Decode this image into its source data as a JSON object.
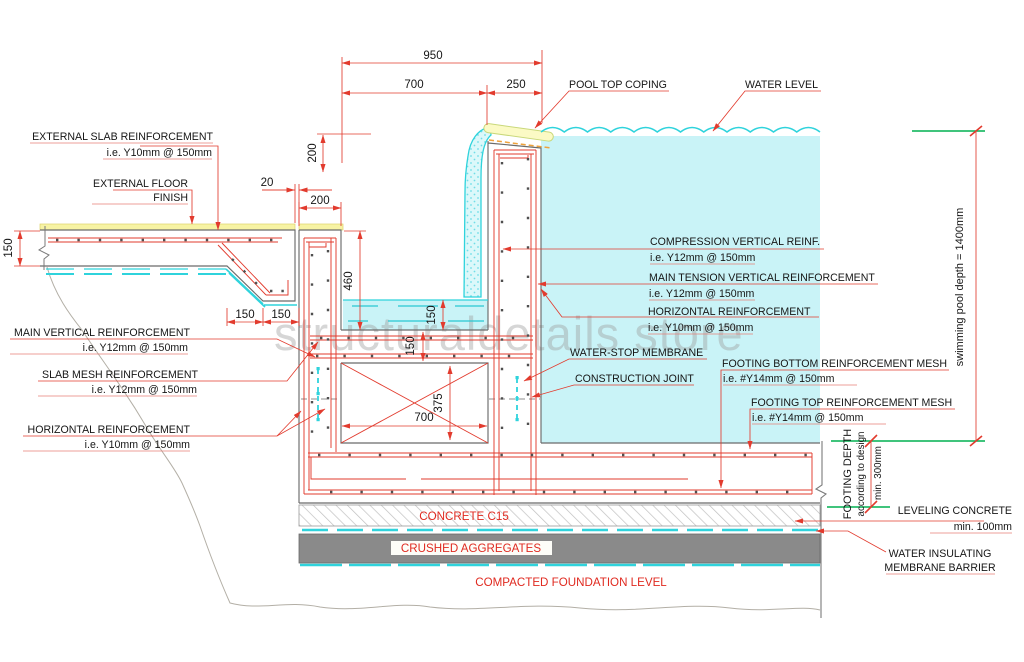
{
  "watermark": "structuraldetails store",
  "dims": {
    "total_width": "950",
    "channel_width": "700",
    "wall_top_width": "250",
    "coping_height": "200",
    "gutter_wall_width": "200",
    "expansion_joint": "20",
    "slab_thickness": "150",
    "slab_edge_seg1": "150",
    "slab_edge_seg2": "150",
    "gutter_depth": "460",
    "gutter_water_depth": "150",
    "gutter_slab_thickness": "150",
    "footing_key_width": "700",
    "footing_key_height": "375"
  },
  "annotations": {
    "external_slab_reinforcement": "EXTERNAL SLAB REINFORCEMENT",
    "external_slab_reinforcement_spec": "i.e. Y10mm @ 150mm",
    "external_floor_finish_1": "EXTERNAL FLOOR",
    "external_floor_finish_2": "FINISH",
    "main_vertical_reinforcement": "MAIN VERTICAL REINFORCEMENT",
    "main_vertical_reinforcement_spec": "i.e. Y12mm @ 150mm",
    "slab_mesh_reinforcement": "SLAB MESH REINFORCEMENT",
    "slab_mesh_reinforcement_spec": "i.e. Y12mm @ 150mm",
    "horizontal_reinforcement_left": "HORIZONTAL REINFORCEMENT",
    "horizontal_reinforcement_left_spec": "i.e. Y10mm @ 150mm",
    "pool_top_coping": "POOL TOP COPING",
    "water_level": "WATER LEVEL",
    "compression_vertical_reinf": "COMPRESSION VERTICAL REINF.",
    "compression_vertical_reinf_spec": "i.e. Y12mm @ 150mm",
    "main_tension_vertical_reinforcement": "MAIN TENSION VERTICAL REINFORCEMENT",
    "main_tension_spec": "i.e. Y12mm @ 150mm",
    "horizontal_reinforcement_right": "HORIZONTAL REINFORCEMENT",
    "horizontal_reinforcement_right_spec": "i.e. Y10mm @ 150mm",
    "water_stop_membrane": "WATER-STOP MEMBRANE",
    "construction_joint": "CONSTRUCTION JOINT",
    "footing_bottom_mesh": "FOOTING BOTTOM REINFORCEMENT MESH",
    "footing_bottom_mesh_spec": "i.e. #Y14mm @ 150mm",
    "footing_top_mesh": "FOOTING TOP REINFORCEMENT MESH",
    "footing_top_mesh_spec": "i.e. #Y14mm @ 150mm",
    "concrete_c15": "CONCRETE C15",
    "crushed_aggregates": "CRUSHED AGGREGATES",
    "compacted_foundation_level": "COMPACTED FOUNDATION LEVEL",
    "leveling_concrete": "LEVELING CONCRETE",
    "leveling_concrete_spec": "min. 100mm",
    "water_insulating_1": "WATER INSULATING",
    "water_insulating_2": "MEMBRANE BARRIER",
    "footing_depth_1": "FOOTING DEPTH",
    "footing_depth_2": "according to design",
    "footing_depth_3": "min. 300mm",
    "pool_depth": "swimming pool depth = 1400mm"
  },
  "colors": {
    "dimension_red": "#e23b2e",
    "water_fill_cyan": "#c9f3f7",
    "membrane_cyan": "#2fd3dc",
    "level_green": "#00b050",
    "finish_yellow": "#f7f3a4",
    "aggregate_gray": "#8a8a8a"
  }
}
